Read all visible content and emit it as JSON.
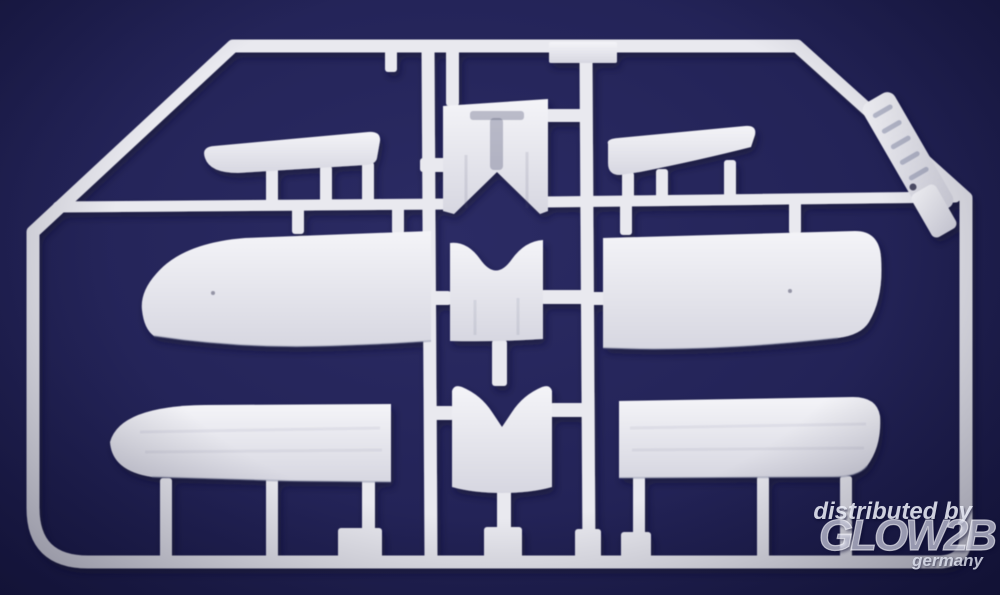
{
  "scene": {
    "description": "Photograph of a white injection-molded model kit sprue (biplane aircraft parts: wings, tailplanes, fuselage and cowling sections) on a dark navy background",
    "parts": [
      "outer-frame",
      "mid-rail",
      "left-vertical-rail",
      "right-vertical-rail",
      "left-tailplane",
      "right-tailplane",
      "left-upper-wing-panel",
      "right-upper-wing-panel",
      "left-lower-wing-panel",
      "right-lower-wing-panel",
      "upper-fuselage-deck",
      "mid-cowling-section",
      "front-cowling-section",
      "small-rectangular-part",
      "molding-gates",
      "brand-tag-large",
      "brand-tag-small"
    ]
  },
  "colors": {
    "bgLight": "#2b2b64",
    "bg": "#232357",
    "bgEdge": "#191943",
    "plastic": "#e9e9ef",
    "plasticLight": "#f4f4f8",
    "plasticDark": "#d7d7e1",
    "shadow": "#0c0c2e",
    "watermark": "#eef0fa"
  },
  "watermark": {
    "line1": "distributed by",
    "line2": "GLOW2B",
    "line3": "germany"
  }
}
